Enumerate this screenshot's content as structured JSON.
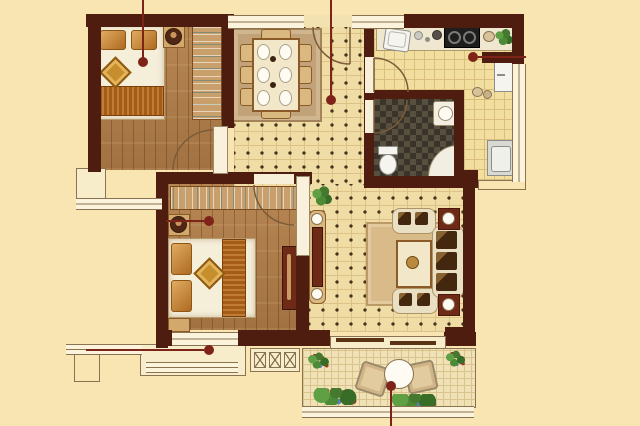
{
  "meta": {
    "type": "apartment-floor-plan",
    "width_px": 640,
    "height_px": 426,
    "visible_text": ""
  },
  "palette": {
    "bg": "#F8E5B2",
    "wall": "#4F1C10",
    "wallLine": "#8A7350",
    "leader": "#7E2318",
    "tile": "#EFDDA5",
    "tileLine": "#DCC287",
    "tileDot": "#46331F",
    "wood": "#AC7A48",
    "kitchen": "#F2DF9F",
    "kitchenLine": "#D9BE7D",
    "counter": "#EFE7CF",
    "bath": "#57503F",
    "bathDark": "#3A342A",
    "windowFill": "#FBF3DC",
    "rugDining": "#C2A379",
    "rugLiving": "#D8BB89",
    "bedSheet": "#F5EED9",
    "pillow": "#C07A2B",
    "blanket": "#A55C17",
    "woodFurn": "#C9A06C",
    "sofa": "#E9DFC3",
    "cushion": "#43270F",
    "accentRed": "#6E2A16",
    "appliance": "#F5F4EE",
    "green": "#45792F",
    "greenLight": "#5FA044",
    "flowerRed": "#B03226",
    "tableBlue": "#86AECB"
  },
  "rooms": [
    {
      "id": "bedroom-top-left",
      "floor": "wood",
      "furniture": [
        "double-bed",
        "two-pillows",
        "diamond-throw",
        "nightstand-lamp",
        "wardrobe-with-hangers",
        "swing-door"
      ]
    },
    {
      "id": "dining-area",
      "floor": "tile-with-dots",
      "furniture": [
        "area-rug",
        "dining-table",
        "six-place-settings",
        "eight-chairs"
      ]
    },
    {
      "id": "entry-hall",
      "floor": "tile-with-dots",
      "furniture": [
        "entry-door"
      ]
    },
    {
      "id": "kitchen",
      "floor": "yellow-grid-tile",
      "furniture": [
        "counter",
        "sink",
        "two-burner-stove",
        "potted-plant",
        "refrigerator",
        "washing-machine",
        "swing-door"
      ]
    },
    {
      "id": "bathroom",
      "floor": "dark-checker-tile",
      "furniture": [
        "toilet",
        "shower-tray",
        "corner-basin",
        "swing-door"
      ]
    },
    {
      "id": "bedroom-lower-left",
      "floor": "wood",
      "furniture": [
        "double-bed",
        "two-pillows",
        "diamond-throw",
        "two-nightstands",
        "wardrobe-with-hangers",
        "tv-cabinet",
        "bay-window",
        "swing-door"
      ]
    },
    {
      "id": "living-room",
      "floor": "tile-with-dots",
      "furniture": [
        "sofa",
        "two-armchairs",
        "coffee-table",
        "area-rug",
        "two-side-tables",
        "console-table",
        "potted-plant"
      ]
    },
    {
      "id": "balcony",
      "floor": "fine-grid-tile",
      "furniture": [
        "two-floor-cushions",
        "round-blue-table",
        "flower-planters",
        "sliding-door"
      ]
    }
  ],
  "leader_lines": [
    {
      "name": "bedroom-top-left-label-line",
      "x1": 143,
      "y1": 0,
      "x2": 143,
      "y2": 60,
      "dot_x": 143,
      "dot_y": 62
    },
    {
      "name": "hall-label-line",
      "x1": 331,
      "y1": 0,
      "x2": 331,
      "y2": 98,
      "dot_x": 331,
      "dot_y": 100
    },
    {
      "name": "kitchen-label-line",
      "x1": 478,
      "y1": 57,
      "x2": 526,
      "y2": 57,
      "dot_x": 473,
      "dot_y": 57
    },
    {
      "name": "bedroom-lower-left-label-line",
      "x1": 166,
      "y1": 221,
      "x2": 204,
      "y2": 221,
      "dot_x": 209,
      "dot_y": 221
    },
    {
      "name": "bay-window-label-line",
      "x1": 86,
      "y1": 350,
      "x2": 204,
      "y2": 350,
      "dot_x": 209,
      "dot_y": 350
    },
    {
      "name": "balcony-label-line",
      "x1": 391,
      "y1": 390,
      "x2": 391,
      "y2": 426,
      "dot_x": 391,
      "dot_y": 386
    }
  ],
  "doors": [
    {
      "name": "bedroom-top-left-door",
      "arc": "M 213 130 A 40 40 0 0 0 173 170"
    },
    {
      "name": "entry-door",
      "arc": "M 350 64 A 37 37 0 0 1 313 27",
      "leaf": "M 350 27 L 350 64"
    },
    {
      "name": "kitchen-door",
      "arc": "M 374 58 A 34 34 0 0 1 408 92",
      "leaf": "M 374 92 L 374 58"
    },
    {
      "name": "bathroom-door",
      "arc": "M 374 133 A 33 33 0 0 0 407 100",
      "leaf": "M 374 100 L 374 133"
    },
    {
      "name": "bedroom-lower-left-door",
      "arc": "M 254 185 A 40 40 0 0 0 294 225"
    }
  ]
}
